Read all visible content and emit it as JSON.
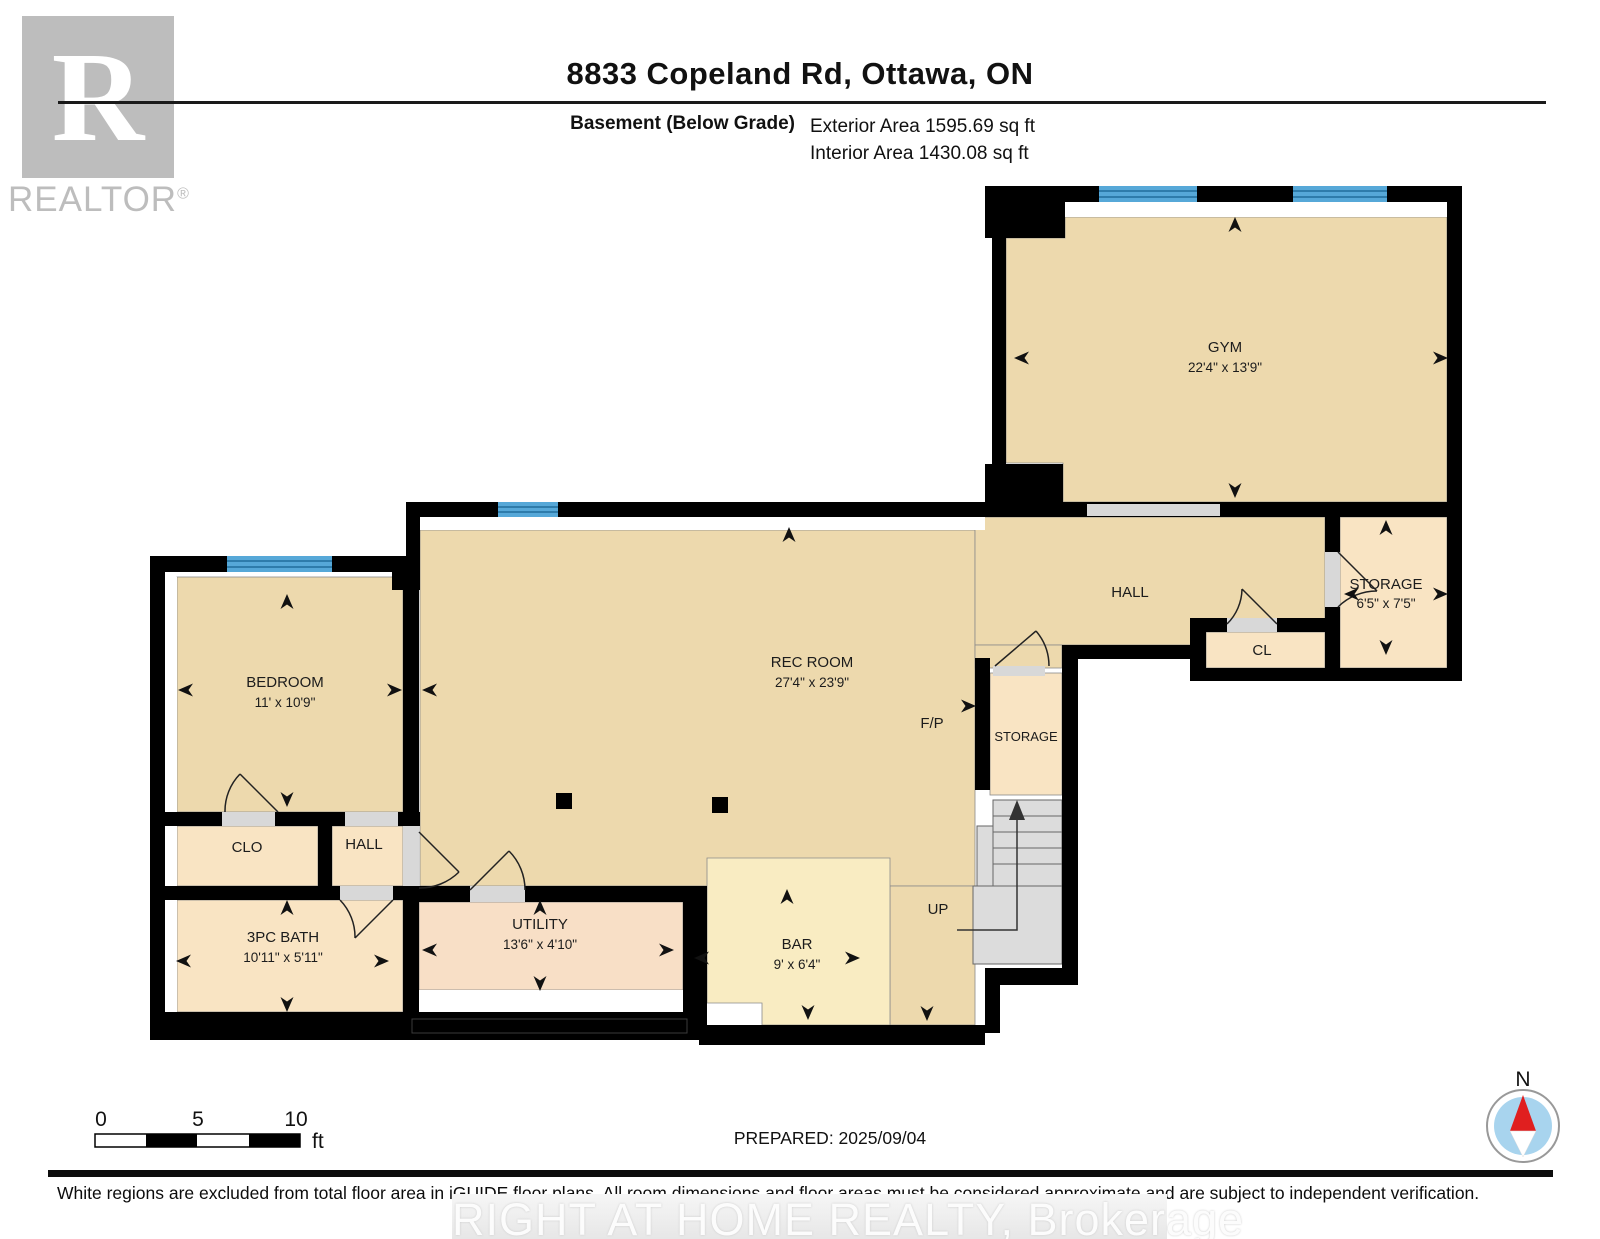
{
  "header": {
    "logo_letter": "R",
    "logo_text": "REALTOR",
    "logo_reg": "®",
    "title": "8833 Copeland Rd, Ottawa, ON",
    "floor_label": "Basement (Below Grade)",
    "exterior_area": "Exterior Area 1595.69 sq ft",
    "interior_area": "Interior Area 1430.08 sq ft"
  },
  "rooms": {
    "gym": {
      "name": "GYM",
      "dims": "22'4\" x 13'9\""
    },
    "hall": {
      "name": "HALL"
    },
    "storage": {
      "name": "STORAGE",
      "dims": "6'5\" x 7'5\""
    },
    "cl": {
      "name": "CL"
    },
    "rec": {
      "name": "REC ROOM",
      "dims": "27'4\" x 23'9\""
    },
    "fireplace": {
      "name": "F/P"
    },
    "storage2": {
      "name": "STORAGE"
    },
    "stairs": {
      "name": "UP"
    },
    "bedroom": {
      "name": "BEDROOM",
      "dims": "11' x 10'9\""
    },
    "clo": {
      "name": "CLO"
    },
    "hall2": {
      "name": "HALL"
    },
    "bath": {
      "name": "3PC BATH",
      "dims": "10'11\" x 5'11\""
    },
    "utility": {
      "name": "UTILITY",
      "dims": "13'6\" x 4'10\""
    },
    "bar": {
      "name": "BAR",
      "dims": "9' x 6'4\""
    }
  },
  "scale_bar": {
    "start": "0",
    "mid": "5",
    "end": "10",
    "unit": "ft"
  },
  "compass": {
    "north": "N"
  },
  "footer": {
    "prepared": "PREPARED: 2025/09/04",
    "disclaimer": "White regions are excluded from total floor area in iGUIDE floor plans. All room dimensions and floor areas must be considered approximate and are subject to independent verification.",
    "watermark": "RIGHT AT HOME REALTY, Brokerage"
  },
  "colors": {
    "wall": "#000000",
    "room_main": "#edd9ad",
    "room_small": "#f9e4c3",
    "room_utility": "#f8dfc6",
    "room_bar": "#f9ecc2",
    "window_blue": "#56a8d8",
    "window_stripe": "#2e7cab",
    "opening": "#d8d8d8",
    "stairs": "#dcdcdc",
    "outline": "#8a8a8a",
    "logo_gray": "#bdbdbd",
    "compass_blue": "#a8d4ee",
    "compass_red": "#e01f1f"
  }
}
